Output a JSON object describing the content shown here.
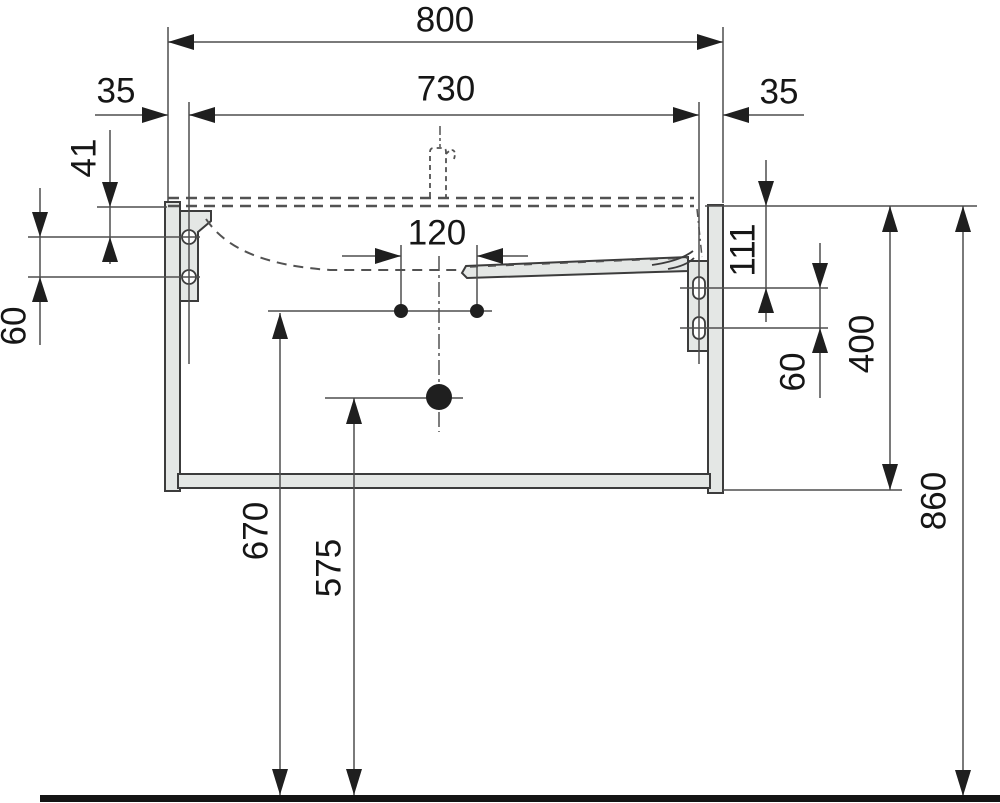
{
  "colors": {
    "background": "#ffffff",
    "outline": "#3c3c3c",
    "dim_line": "#4f4f4f",
    "panel_fill": "#e4e7e5",
    "text": "#161616",
    "floor": "#141414",
    "arrow": "#1f1f1f",
    "hidden": "#525252"
  },
  "dims": {
    "overall_width": "800",
    "fixing_centers_width": "730",
    "offset_left": "35",
    "offset_right": "35",
    "hole_top_offset_left": "41",
    "hole_spacing_left": "60",
    "supply_spacing": "120",
    "slot_top_offset_right": "111",
    "slot_spacing_right": "60",
    "cabinet_height": "400",
    "top_height_above_floor": "860",
    "supply_height_above_floor": "670",
    "drain_height_above_floor": "575"
  }
}
